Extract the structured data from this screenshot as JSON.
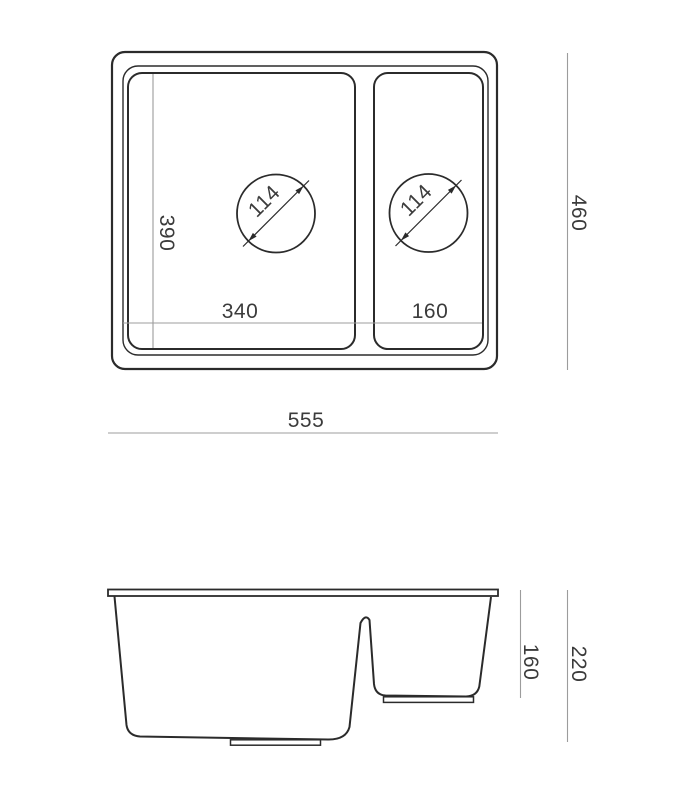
{
  "colors": {
    "outline": "#2b2b2b",
    "dimension_line": "#9c9c9c",
    "label_text": "#3b3b3b",
    "background": "#ffffff"
  },
  "top_view": {
    "overall_width_mm": "555",
    "overall_depth_mm": "460",
    "bowl_inner_depth_mm": "390",
    "main_bowl_width_mm": "340",
    "half_bowl_width_mm": "160",
    "main_drain_diameter_mm": "114",
    "half_drain_diameter_mm": "114"
  },
  "side_view": {
    "overall_height_mm": "220",
    "half_bowl_depth_mm": "160"
  }
}
